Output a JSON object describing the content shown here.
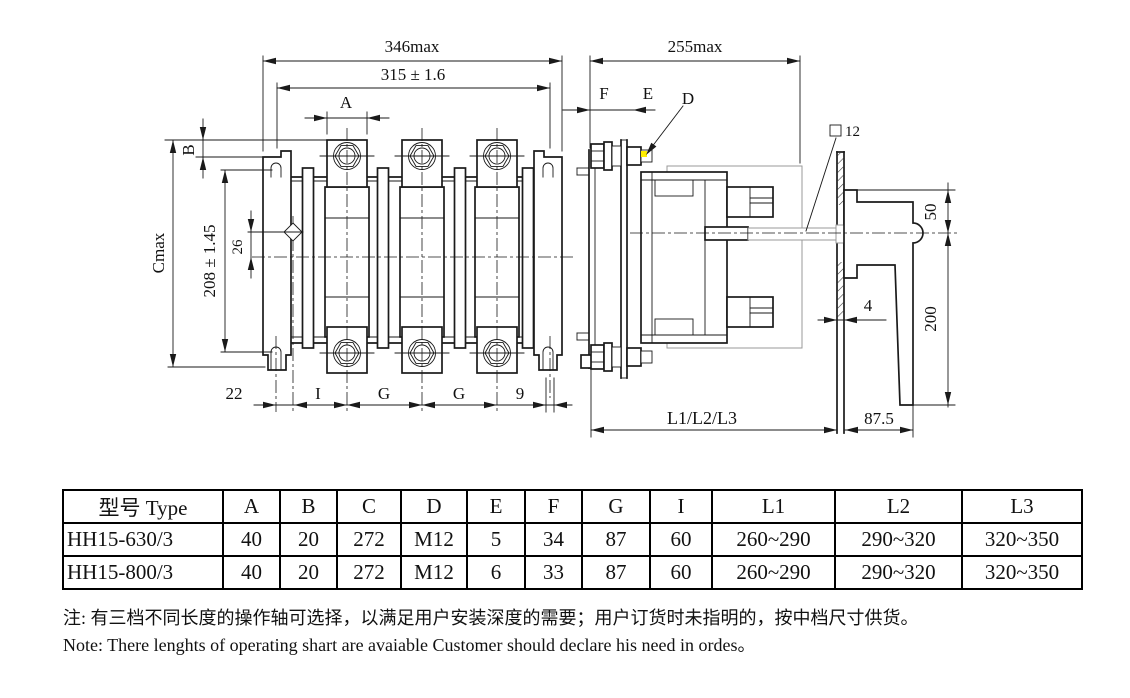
{
  "colors": {
    "line": "#1a1a1a",
    "phantom": "#999999",
    "highlight": "#ffee00"
  },
  "dims_front": {
    "width_max": "346max",
    "hole_spacing": "315 ± 1.6",
    "a": "A",
    "b": "B",
    "cmax": "Cmax",
    "height_spacing": "208 ± 1.45",
    "d26": "26",
    "d22": "22",
    "i": "I",
    "g": "G",
    "d9": "9"
  },
  "dims_side": {
    "depth_max": "255max",
    "f": "F",
    "e": "E",
    "d": "D",
    "square12": "12",
    "d50": "50",
    "d200": "200",
    "d4": "4",
    "d875": "87.5",
    "shaft_len": "L1/L2/L3"
  },
  "table": {
    "headers": [
      "型号 Type",
      "A",
      "B",
      "C",
      "D",
      "E",
      "F",
      "G",
      "I",
      "L1",
      "L2",
      "L3"
    ],
    "rows": [
      [
        "HH15-630/3",
        "40",
        "20",
        "272",
        "M12",
        "5",
        "34",
        "87",
        "60",
        "260~290",
        "290~320",
        "320~350"
      ],
      [
        "HH15-800/3",
        "40",
        "20",
        "272",
        "M12",
        "6",
        "33",
        "87",
        "60",
        "260~290",
        "290~320",
        "320~350"
      ]
    ]
  },
  "notes": {
    "zh": "注: 有三档不同长度的操作轴可选择，以满足用户安装深度的需要；用户订货时未指明的，按中档尺寸供货。",
    "en": "Note: There lenghts of operating shart are avaiable Customer should declare his need in ordes。"
  }
}
